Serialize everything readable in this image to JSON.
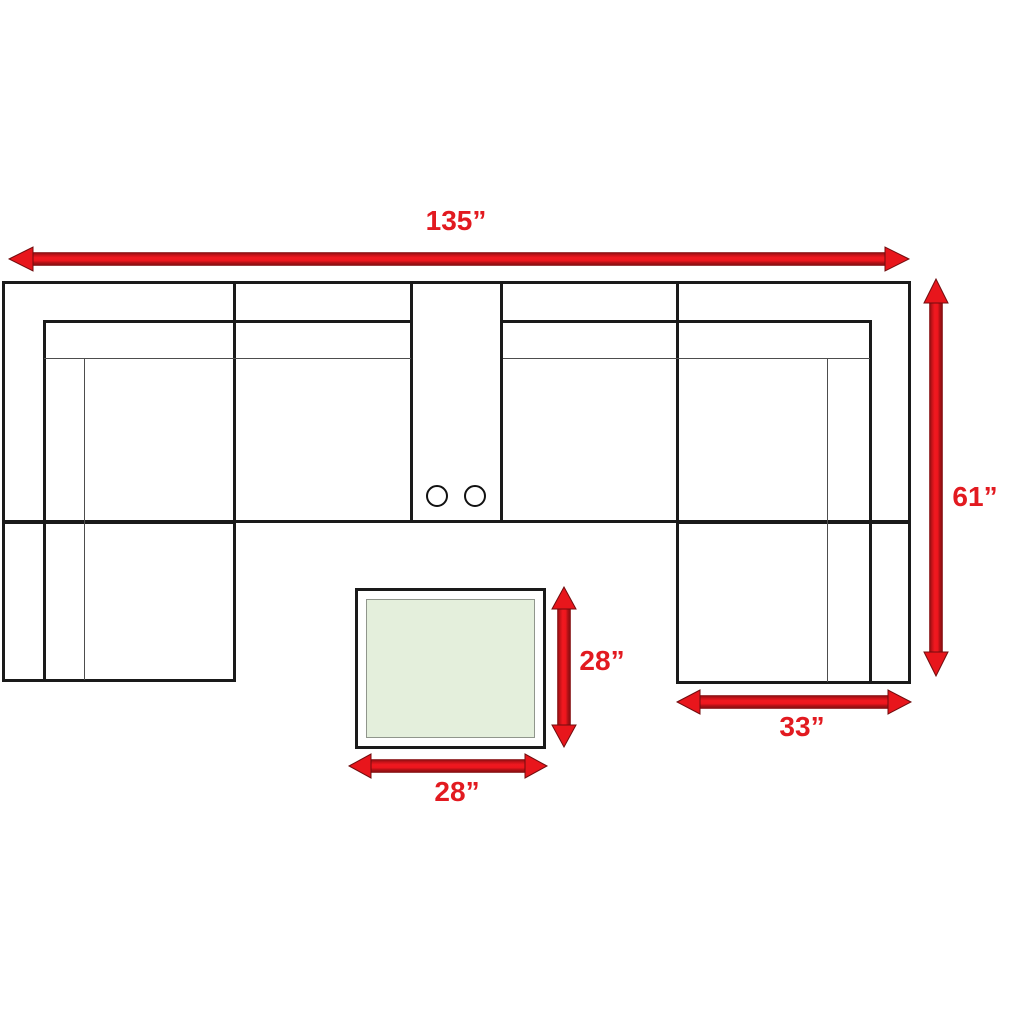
{
  "title": "Sectional sofa with ottoman dimension diagram",
  "dimensions": {
    "overall_width": "135”",
    "overall_depth": "61”",
    "chaise_width": "33”",
    "table_depth": "28”",
    "table_width": "28”"
  },
  "colors": {
    "arrow_red": "#e8161c",
    "label_red": "#e21a20",
    "sofa_outline_black": "#1a1a1a",
    "thin_line_gray": "#4d4d4d",
    "table_fill_green": "#e4efdc",
    "background": "#ffffff"
  }
}
